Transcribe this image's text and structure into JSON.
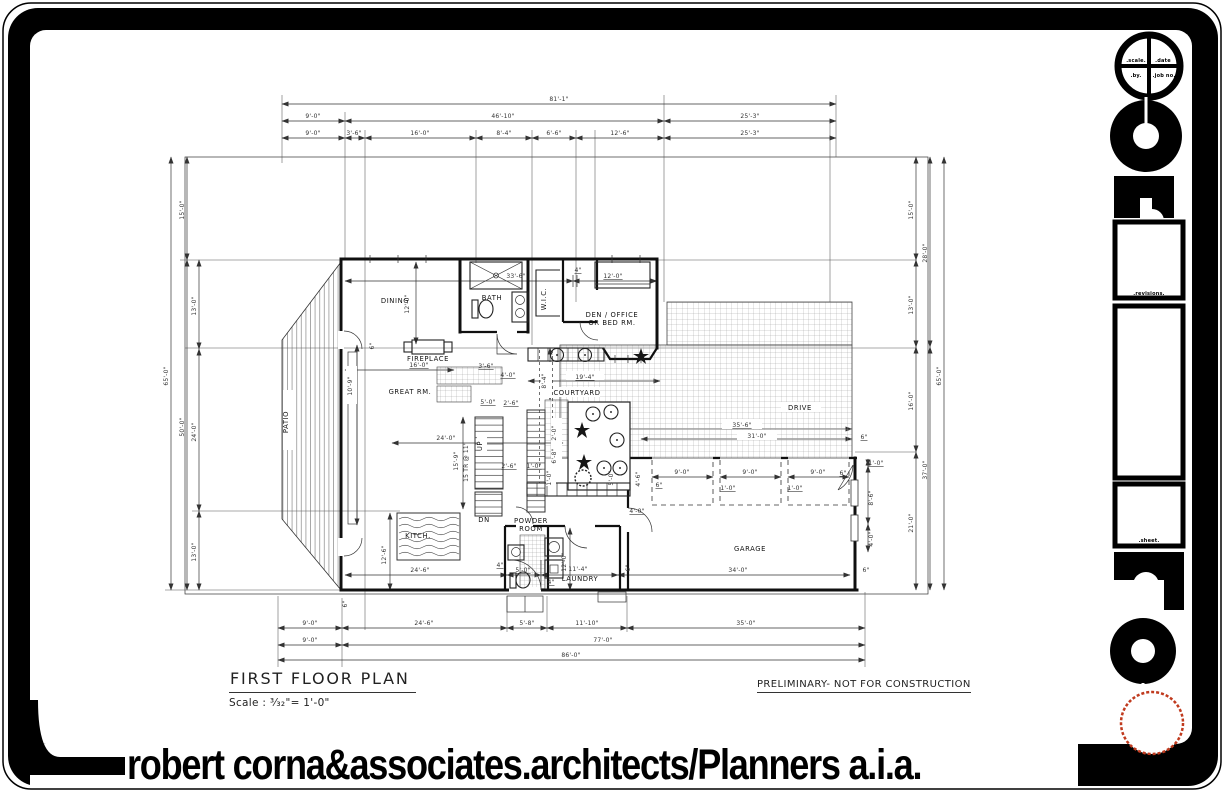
{
  "page": {
    "firm": "robert corna&associates.architects/Planners a.i.a.",
    "title": "FIRST FLOOR PLAN",
    "scale_note": "Scale : ³⁄₃₂\"= 1'-0\"",
    "disclaimer": "PRELIMINARY- NOT FOR CONSTRUCTION"
  },
  "colors": {
    "ink": "#111111",
    "accent_red": "#c03a1e"
  },
  "titleblock": {
    "scale": ".scale.",
    "date": ".date",
    "by": ".by.",
    "job": ".job no.",
    "revisions": ".revisions.",
    "sheet": ".sheet."
  },
  "rooms": {
    "patio": "PATIO",
    "dining": "DINING",
    "bath": "BATH",
    "wic": "W.I.C.",
    "den1": "DEN / OFFICE",
    "den2": "OR BED RM.",
    "fireplace": "FIREPLACE",
    "great": "GREAT RM.",
    "courtyard": "COURTYARD",
    "drive": "DRIVE",
    "kitchen": "KITCH.",
    "dn": "DN",
    "up": "UP",
    "powder1": "POWDER",
    "powder2": "ROOM",
    "laundry": "LAUNDRY",
    "garage": "GARAGE"
  },
  "dims": {
    "top": {
      "whole": "81'-1\"",
      "a": "9'-0\"",
      "b": "46'-10\"",
      "c": "25'-3\"",
      "d": "9'-0\"",
      "e": "3'-6\"",
      "f": "16'-0\"",
      "g": "8'-4\"",
      "h": "6'-6\"",
      "i": "12'-6\"",
      "j": "25'-3\""
    },
    "left": {
      "total": "65'-0\"",
      "a": "15'-0\"",
      "b": "50'-0\"",
      "c": "13'-0\"",
      "d": "24'-0\"",
      "e": "13'-0\""
    },
    "right": {
      "a": "15'-0\"",
      "b": "13'-0\"",
      "c": "16'-0\"",
      "d": "21'-0\"",
      "e": "28'-0\"",
      "f": "37'-0\"",
      "total": "65'-0\""
    },
    "bottom": {
      "a": "9'-0\"",
      "b": "24'-6\"",
      "c": "5'-8\"",
      "d": "11'-10\"",
      "e": "35'-0\"",
      "f": "9'-0\"",
      "g": "77'-0\"",
      "total": "86'-0\""
    },
    "in": {
      "d33_6": "33'-6\"",
      "d4a": "4\"",
      "d12_0a": "12'-0\"",
      "d12_0b": "12'-0\"",
      "d16_0": "16'-0\"",
      "d3_6": "3'-6\"",
      "d4_0a": "4'-0\"",
      "d19_4": "19'-4\"",
      "d8_4": "8'-4\"",
      "d10_9": "10'-9\"",
      "d6a": "6\"",
      "d24_0": "24'-0\"",
      "d15_9": "15'-9\"",
      "d15tr": "15 TR @ 11\"",
      "d5_0a": "5'-0\"",
      "d2_6a": "2'-6\"",
      "d2_0": "2'-0\"",
      "d6_8": "6'-8\"",
      "d2_6b": "2'-6\"",
      "d1_0a": "1'-0\"",
      "d1_0b": "1'-0\"",
      "d5_0b": "5'-0\"",
      "d4_6": "4'-6\"",
      "d4_0b": "4'-0\"",
      "d35_6": "35'-6\"",
      "d31_0": "31'-0\"",
      "d6b": "6\"",
      "d9_0a": "9'-0\"",
      "d9_0b": "9'-0\"",
      "d9_0c": "9'-0\"",
      "d1_0c": "1'-0\"",
      "d1_0d": "1'-0\"",
      "d6c": "6\"",
      "d6d": "6\"",
      "d1_0e": "1'-0\"",
      "d8_6": "8'-6\"",
      "d4_0c": "4'-0\"",
      "d34_0": "34'-0\"",
      "d6e": "6\"",
      "d6f": "6\"",
      "d24_6": "24'-6\"",
      "d5_0c": "5'-0\"",
      "d11_4": "11'-4\"",
      "d12_6": "12'-6\"",
      "d12_0c": "12'-0\"",
      "d4b": "4\"",
      "d4c": "4\"",
      "d6g": "6\""
    }
  }
}
